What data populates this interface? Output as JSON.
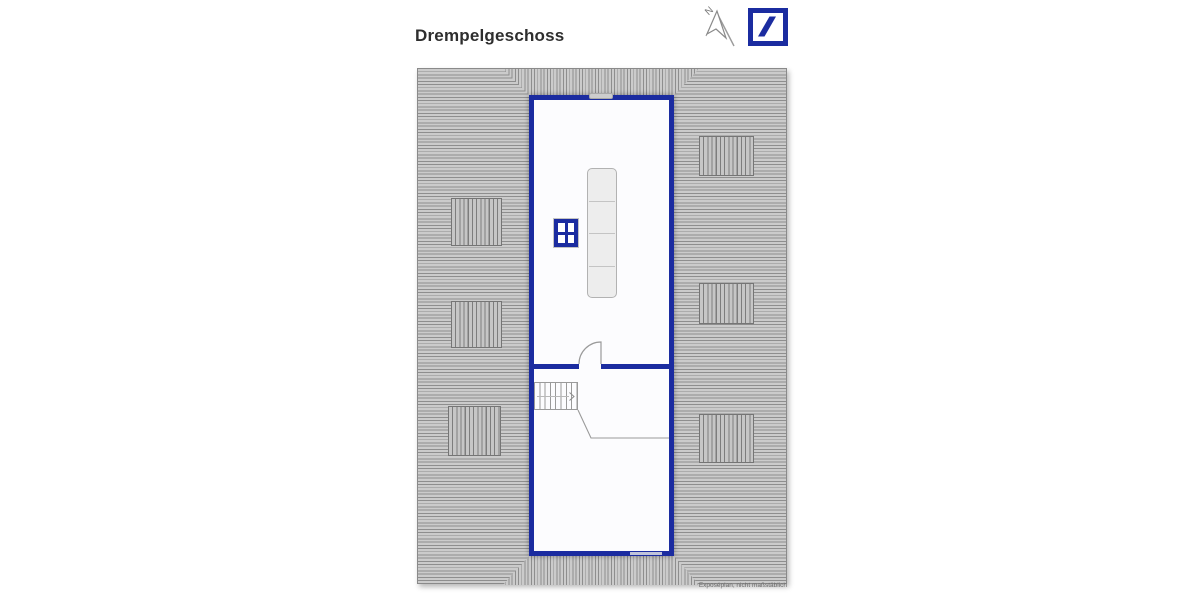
{
  "page": {
    "title": "Drempelgeschoss",
    "footer_note": "Exposéplan, nicht maßstäblich"
  },
  "compass": {
    "label": "N",
    "direction": "upper-left"
  },
  "branding": {
    "logo": "deutsche-bank-slash-in-square",
    "brand_color": "#1B2CA0"
  },
  "colors": {
    "wall": "#1b2ca0",
    "roof_fill": "#cbcbcb",
    "hatch_line": "#8e8e8e",
    "room_fill": "#fcfcfe"
  },
  "floor_plan": {
    "label": "Drempelgeschoss",
    "roof_windows_left": 3,
    "roof_windows_right": 3,
    "symbols": [
      "staircase-up",
      "door-swing",
      "wardrobe",
      "window-grid"
    ]
  }
}
